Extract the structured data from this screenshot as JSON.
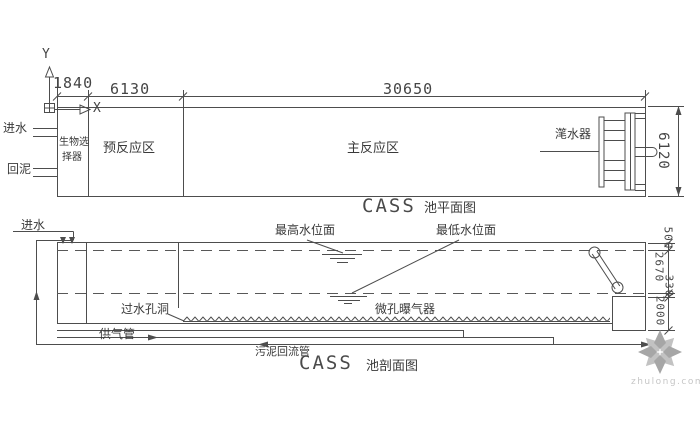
{
  "colors": {
    "line": "#4d4d4d",
    "text": "#3a3a3a",
    "dash": "#585858",
    "watermark_dark": "#a6a6a6",
    "watermark_light": "#c2c2c2",
    "watermark_text": "#c6c6c6"
  },
  "axes": {
    "x": "X",
    "y": "Y"
  },
  "plan": {
    "title_latin": "CASS",
    "title_cjk": "池平面图",
    "dim_width_selector": "1840",
    "dim_width_pre": "6130",
    "dim_width_main": "30650",
    "dim_height": "6120",
    "inlet": "进水",
    "sludge_return": "回泥",
    "bio_selector_line1": "生物选",
    "bio_selector_line2": "择器",
    "pre_reaction": "预反应区",
    "main_reaction": "主反应区",
    "decanter": "滗水器"
  },
  "section": {
    "title_latin": "CASS",
    "title_cjk": "池剖面图",
    "inlet": "进水",
    "max_water_level": "最高水位面",
    "min_water_level": "最低水位面",
    "water_hole": "过水孔洞",
    "aerator": "微孔曝气器",
    "air_pipe": "供气管",
    "sludge_return_pipe": "污泥回流管",
    "dim_freeboard": "500",
    "dim_water_range": "2670",
    "dim_min_to_sump": "330",
    "dim_sump": "2000"
  },
  "watermark": {
    "site": "zhulong.com"
  }
}
